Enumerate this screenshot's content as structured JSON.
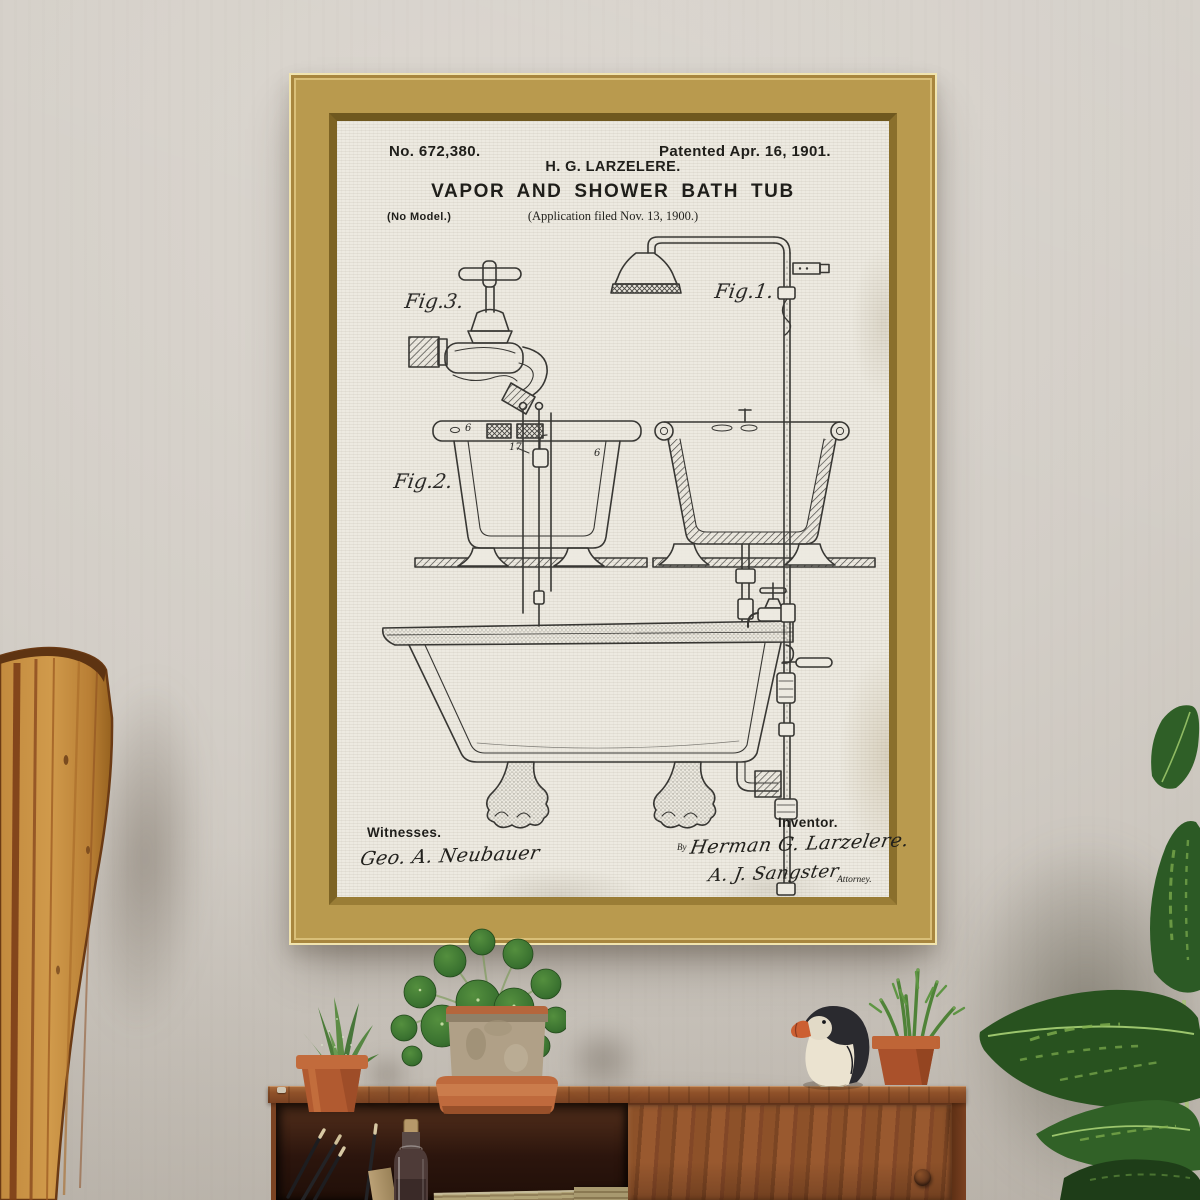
{
  "artwork": {
    "patent_number": "No. 672,380.",
    "patented_date": "Patented Apr. 16, 1901.",
    "inventor_header": "H. G. LARZELERE.",
    "title": "VAPOR AND SHOWER BATH TUB",
    "application_line": "(Application filed Nov. 13, 1900.)",
    "no_model": "(No Model.)",
    "figure_labels": {
      "fig1": "Fig.1.",
      "fig2": "Fig.2.",
      "fig3": "Fig.3."
    },
    "reference_numbers": {
      "rim_left": "6",
      "pipe": "17",
      "rim_right": "6"
    },
    "witnesses_label": "Witnesses.",
    "witness_signature": "Geo. A. Neubauer",
    "inventor_label": "Inventor.",
    "by_prefix": "By",
    "inventor_signature": "Herman G. Larzelere.",
    "attorney_signature": "A. J. Sangster",
    "attorney_label": "Attorney."
  },
  "colors": {
    "wall": "#d3cec7",
    "frame_gold": "#c2a255",
    "canvas_paper": "#edeae1",
    "ink": "#262624",
    "paddle_wood": "#c08a3e",
    "cabinet_teak": "#8a4e2a",
    "terracotta": "#bc6236",
    "stone_pot": "#b0a087",
    "foliage_green": "#3f7a33",
    "dieffenbachia_green": "#2a5523",
    "puffin_black": "#2a2a2f",
    "puffin_beak": "#cc5f32"
  }
}
